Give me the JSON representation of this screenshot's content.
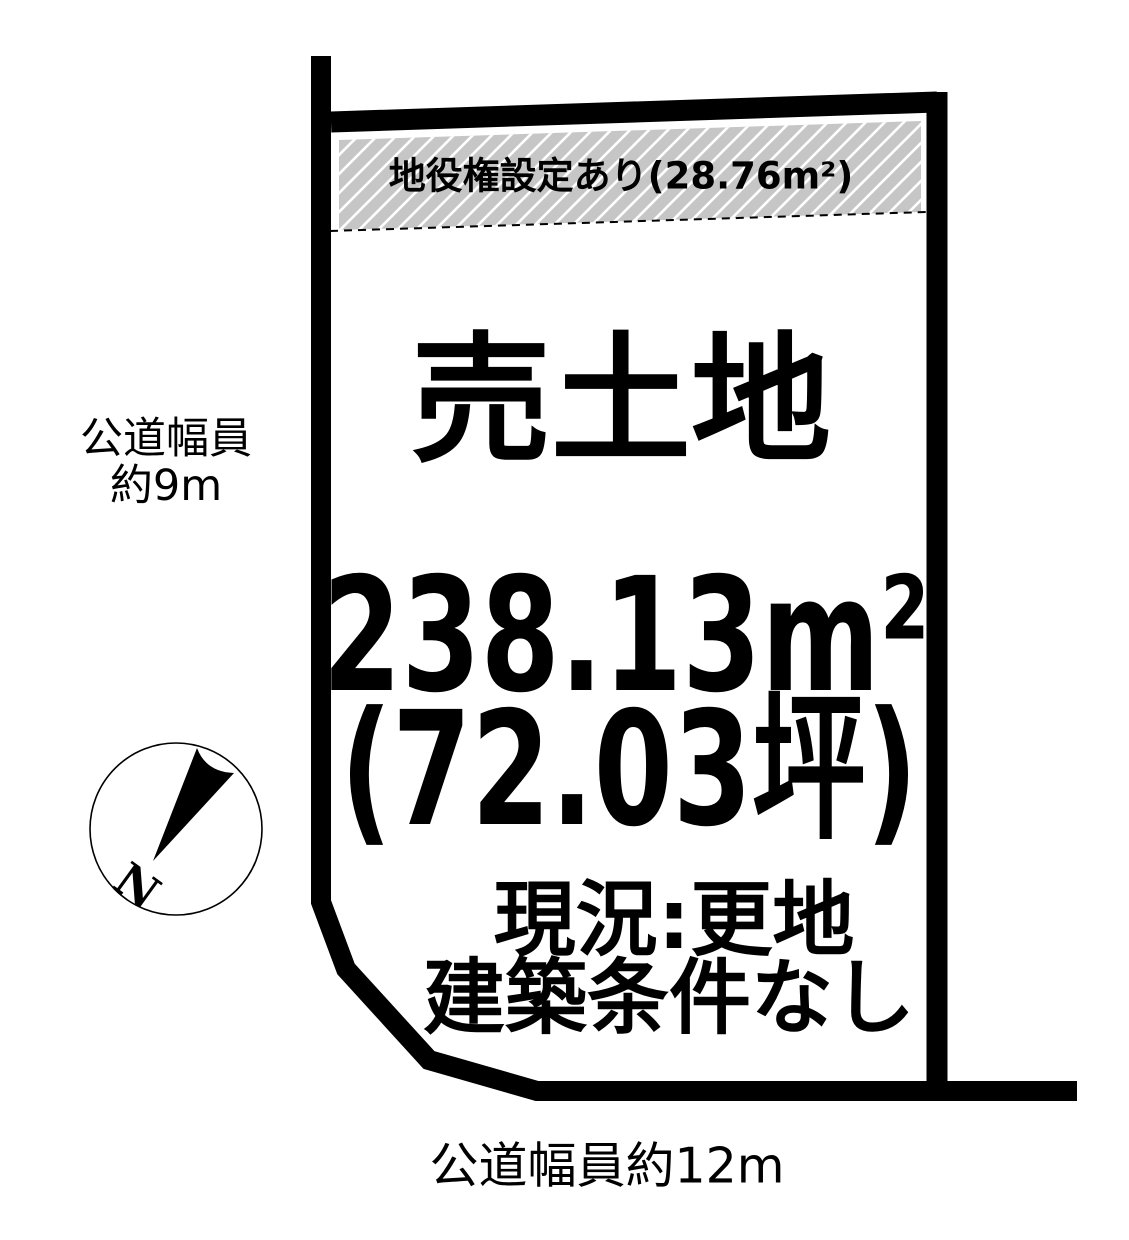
{
  "colors": {
    "background": "#ffffff",
    "outline": "#000000",
    "easement_fill": "#c6c6c6",
    "hatch_line": "#ffffff",
    "text": "#000000"
  },
  "plot": {
    "easement_label": "地役権設定あり(28.76m²)",
    "title": "売土地",
    "area_sqm": "238.13m²",
    "area_tsubo": "(72.03坪)",
    "status_line1": "現況:更地",
    "status_line2": "建築条件なし"
  },
  "roads": {
    "left_line1": "公道幅員",
    "left_line2": "約9m",
    "left_width": "約9m",
    "bottom_label": "公道幅員約12m",
    "bottom_width": "約12m"
  },
  "compass": {
    "north_label": "N"
  }
}
